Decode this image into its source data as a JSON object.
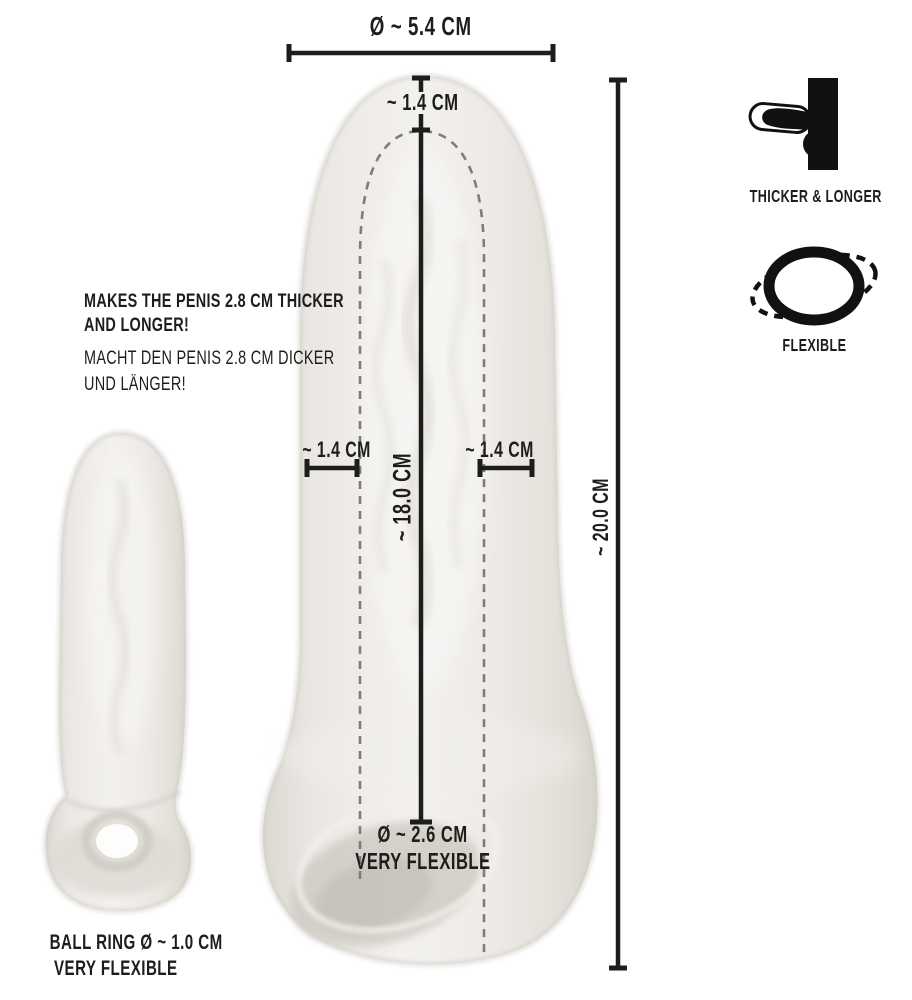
{
  "diagram_title": "Penis sleeve dimension diagram",
  "measurements": {
    "outer_diameter": "Ø ~ 5.4 CM",
    "tip_wall": "~ 1.4 CM",
    "left_wall": "~ 1.4 CM",
    "right_wall": "~ 1.4 CM",
    "inner_length": "~ 18.0 CM",
    "total_length": "~ 20.0 CM",
    "opening_diameter": "Ø ~ 2.6 CM",
    "opening_note": "VERY FLEXIBLE",
    "ball_ring": "BALL RING Ø ~ 1.0 CM",
    "ball_ring_note": "VERY FLEXIBLE"
  },
  "description": {
    "en_line1": "MAKES THE PENIS 2.8 CM THICKER",
    "en_line2": "AND LONGER!",
    "de_line1": "MACHT DEN PENIS 2.8 CM DICKER",
    "de_line2": "UND LÄNGER!"
  },
  "features": [
    {
      "id": "thicker-longer",
      "label": "THICKER & LONGER"
    },
    {
      "id": "flexible",
      "label": "FLEXIBLE"
    }
  ],
  "colors": {
    "text": "#1d1d1b",
    "measure_line": "#1d1d1b",
    "dashed_line": "#7d7d7d",
    "product_light": "#f3f1ee",
    "product_mid": "#eae7e2",
    "product_edge": "#d7d3cc",
    "background": "#ffffff"
  }
}
